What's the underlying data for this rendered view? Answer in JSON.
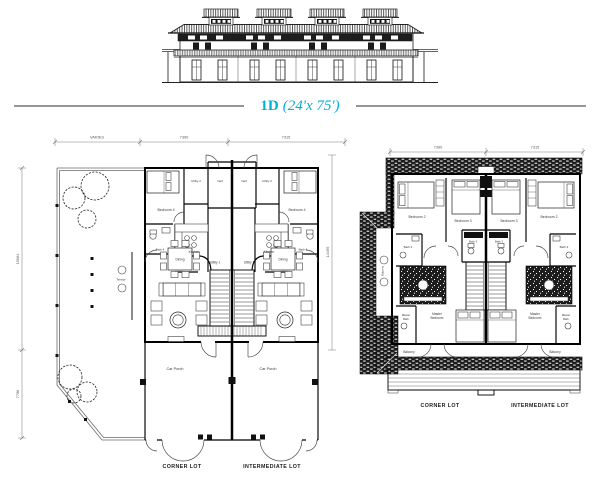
{
  "title": {
    "part1": "1D",
    "part2": "(24'x 75')",
    "accent_color": "#00b1d4"
  },
  "ground_floor": {
    "dim_varies": "VARIES",
    "dim_w1": "7390",
    "dim_w2": "7315",
    "dim_left": "15064",
    "dim_left_lower": "7796",
    "dim_right": "14495",
    "bedroom4": "Bedroom 4",
    "utility2": "Utility 2",
    "yard": "Yard",
    "kitchen": "Kitchen",
    "bath4": "Bath 4",
    "dining": "Dining",
    "utility1": "Utility 1",
    "terrace": "Terrace",
    "car_porch": "Car Porch",
    "corner_lot": "CORNER LOT",
    "intermediate_lot": "INTERMEDIATE LOT"
  },
  "first_floor": {
    "dim_w1": "7390",
    "dim_w2": "7315",
    "bedroom2": "Bedroom 2",
    "bedroom3": "Bedroom 3",
    "bath2": "Bath 2",
    "bath3": "Bath 3",
    "master_l1": "Master",
    "master_l2": "Bedroom",
    "masterbath_l1": "Master",
    "masterbath_l2": "Bath",
    "balcony": "Balcony",
    "corner_lot": "CORNER LOT",
    "intermediate_lot": "INTERMEDIATE LOT"
  }
}
